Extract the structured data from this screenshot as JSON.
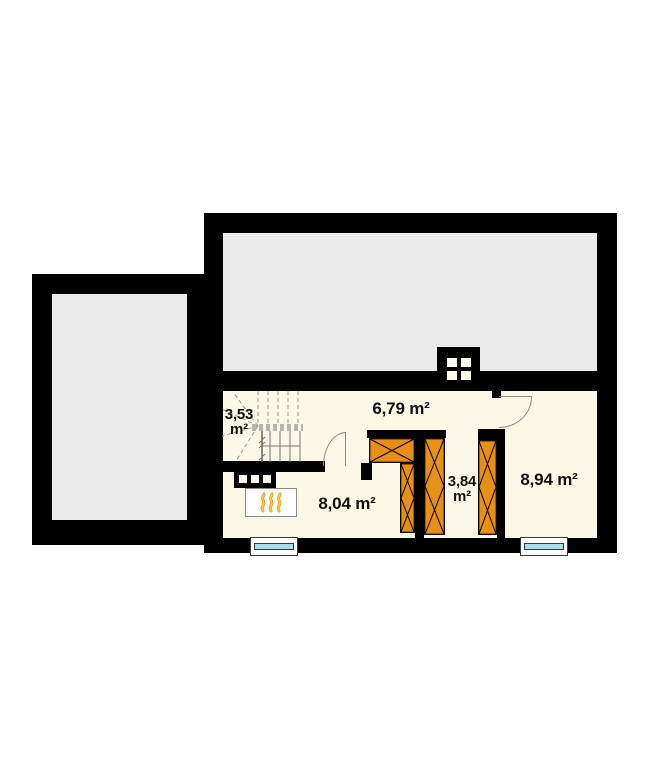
{
  "floor_plan": {
    "rooms": {
      "staircase": {
        "area": "3,53",
        "unit": "m²"
      },
      "hallway": {
        "area_label": "6,79 m²"
      },
      "fireplace_room": {
        "area_label": "8,04 m²"
      },
      "wardrobe_passage": {
        "area": "3,84",
        "unit": "m²"
      },
      "side_room": {
        "area_label": "8,94 m²"
      }
    },
    "colors": {
      "wall": "#000000",
      "room-gray": "#ebebeb",
      "floor-cream": "#fbf8e8",
      "wardrobe": "#e78f16",
      "glass": "#a8dcf0",
      "flame": "#f09d1c",
      "symbol-line": "#8a8a8a"
    }
  }
}
